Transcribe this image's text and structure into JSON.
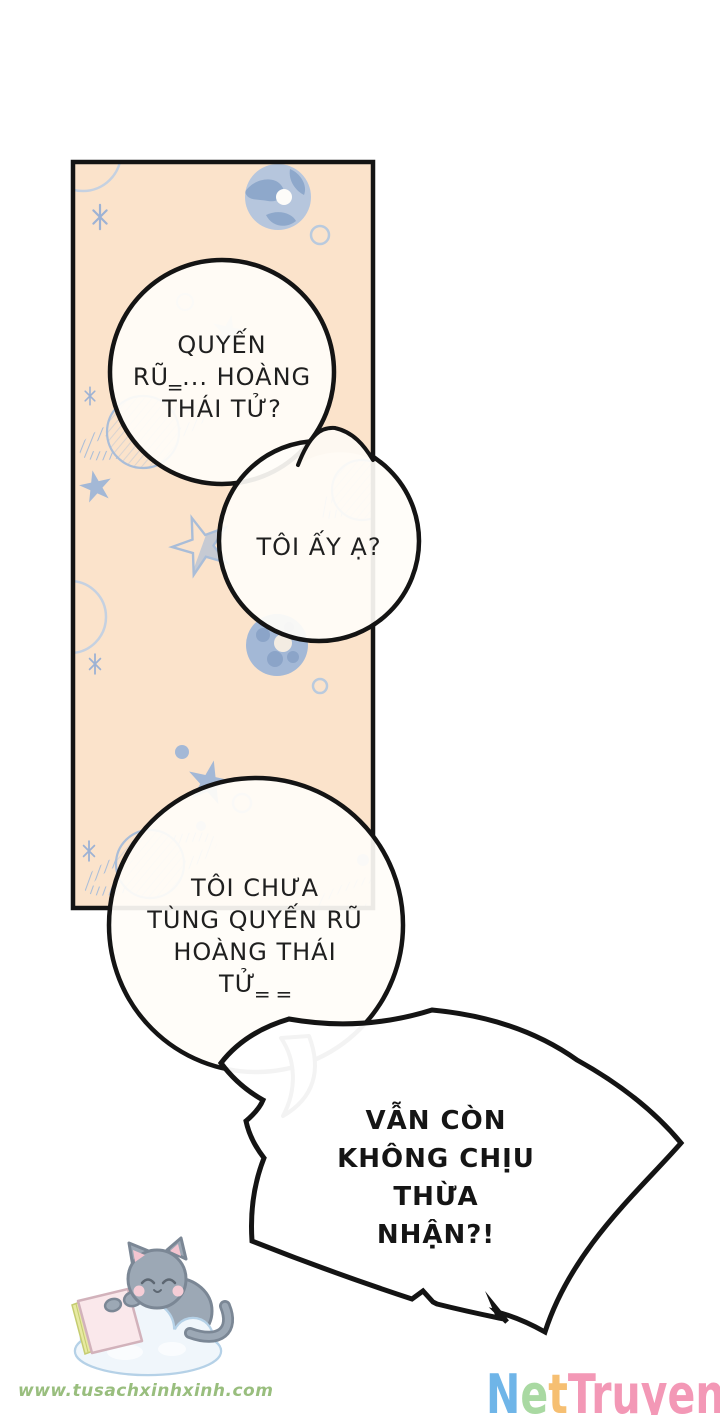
{
  "comic": {
    "panel_bubbles": [
      {
        "name": "bubble-1",
        "lines": [
          "QUYẾN",
          "RŨ‗... HOÀNG",
          "THÁI TỬ?"
        ]
      },
      {
        "name": "bubble-2",
        "lines": [
          "TÔI ẤY Ạ?"
        ]
      },
      {
        "name": "bubble-3",
        "lines": [
          "TÔI CHƯA",
          "TÙNG QUYẾN RŨ",
          "HOÀNG THÁI",
          "TỬ‗ ‗"
        ]
      },
      {
        "name": "burst-bubble",
        "lines": [
          "VẪN CÒN",
          "KHÔNG CHỊU THỪA",
          "NHẬN?!"
        ]
      }
    ],
    "colors": {
      "panel_fill": "#fbe3cb",
      "doodle_solid": "#a3b8d6",
      "doodle_outline": "#b9cade",
      "ink": "#141414",
      "bubble_fill": "#fffdf8"
    }
  },
  "watermarks": {
    "site_url": "www.tusachxinhxinh.com",
    "site_url_color": "#8eb871",
    "logo_segments": [
      {
        "text": "N",
        "color": "#6fb5e8"
      },
      {
        "text": "e",
        "color": "#a9d9a2"
      },
      {
        "text": "t",
        "color": "#f6bf72"
      },
      {
        "text": "Truyen",
        "color": "#f398b6"
      }
    ]
  }
}
